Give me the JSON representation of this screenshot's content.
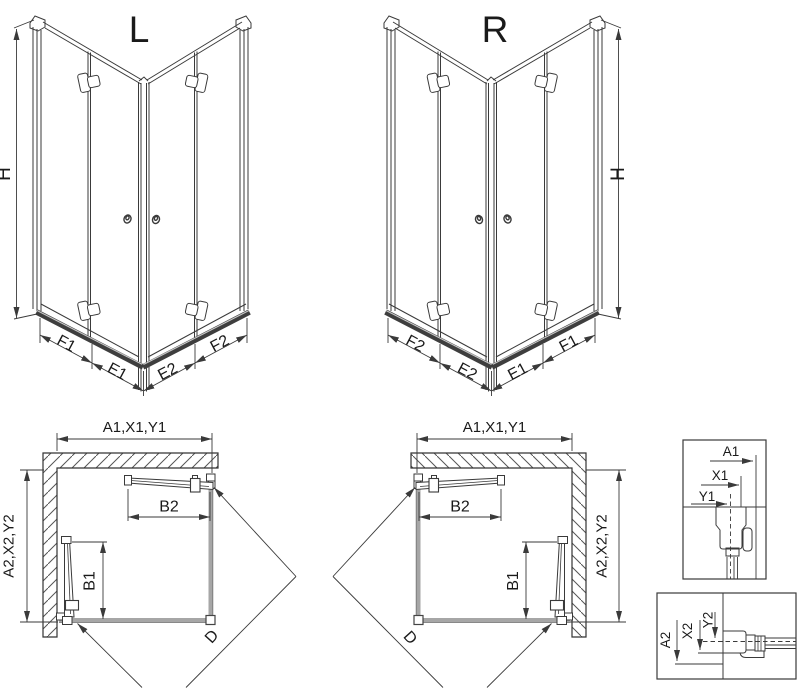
{
  "drawing": {
    "type": "shower-enclosure-technical-drawing",
    "views": [
      "isometric-left-L",
      "isometric-right-R",
      "plan-left",
      "plan-right",
      "wall-profile-detail-top",
      "wall-profile-detail-bottom"
    ]
  },
  "colors": {
    "line": "#3a3a3a",
    "glass_gray": "#a6a6a6",
    "rail_dark": "#3e3e3e",
    "hatch": "#555555",
    "background": "#ffffff"
  },
  "variants": {
    "left": "L",
    "right": "R"
  },
  "dimensions": {
    "height": "H",
    "f1": "F1",
    "e1": "E1",
    "e2": "E2",
    "f2": "F2",
    "plan_width": "A1,X1,Y1",
    "plan_depth": "A2,X2,Y2",
    "b1": "B1",
    "b2": "B2",
    "diagonal": "D",
    "a1": "A1",
    "x1": "X1",
    "y1": "Y1",
    "a2": "A2",
    "x2": "X2",
    "y2": "Y2"
  }
}
